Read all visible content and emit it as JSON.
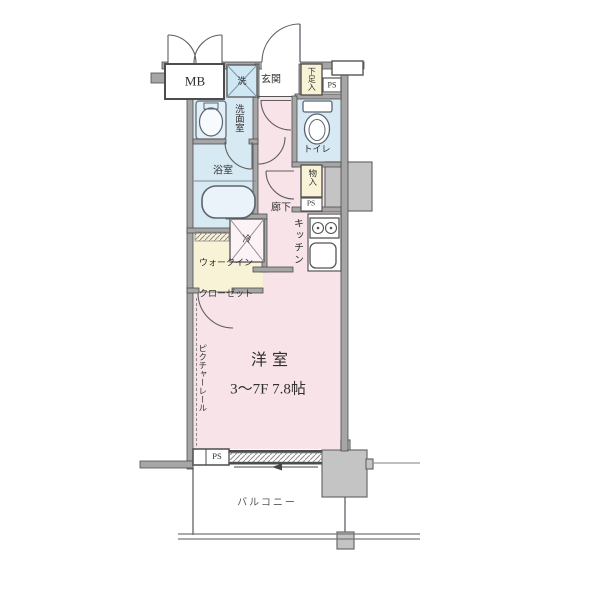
{
  "plan": {
    "title": "ワンルーム間取り図",
    "labels": {
      "mb": "MB",
      "washing_machine": "洗",
      "entrance": "玄関",
      "shoe_cabinet": "下足入",
      "ps_top": "PS",
      "washroom": "洗面室",
      "toilet": "トイレ",
      "bathroom": "浴室",
      "hallway": "廊下",
      "storage": "物入",
      "ps_mid": "PS",
      "kitchen": "キッチン",
      "refrigerator": "冷",
      "walk_in_closet_line1": "ウォークイン",
      "walk_in_closet_line2": "クローゼット",
      "main_room": "洋室",
      "main_room_size": "3〜7F 7.8帖",
      "picture_rail": "ピクチャーレール",
      "ps_bottom": "PS",
      "balcony": "バルコニー"
    },
    "colors": {
      "room_pink": "#f8e4e8",
      "wet_blue": "#d7eaf4",
      "closet_yellow": "#f8f3d6",
      "shaft_gray": "#c4c4c4",
      "wall_gray": "#a6a6a6",
      "line": "#4d4d4d"
    },
    "icons": [
      "bathtub-icon",
      "toilet-icon",
      "washbasin-icon",
      "stove-icon",
      "kitchen-sink-icon",
      "washing-machine-icon",
      "refrigerator-icon",
      "entrance-door-arc",
      "mb-door-arcs",
      "washroom-door-arc",
      "bathroom-door-arc",
      "toilet-door-arc",
      "closet-door-arc",
      "sliding-window-icon",
      "hanger-rail-icon",
      "picture-rail-line"
    ]
  }
}
